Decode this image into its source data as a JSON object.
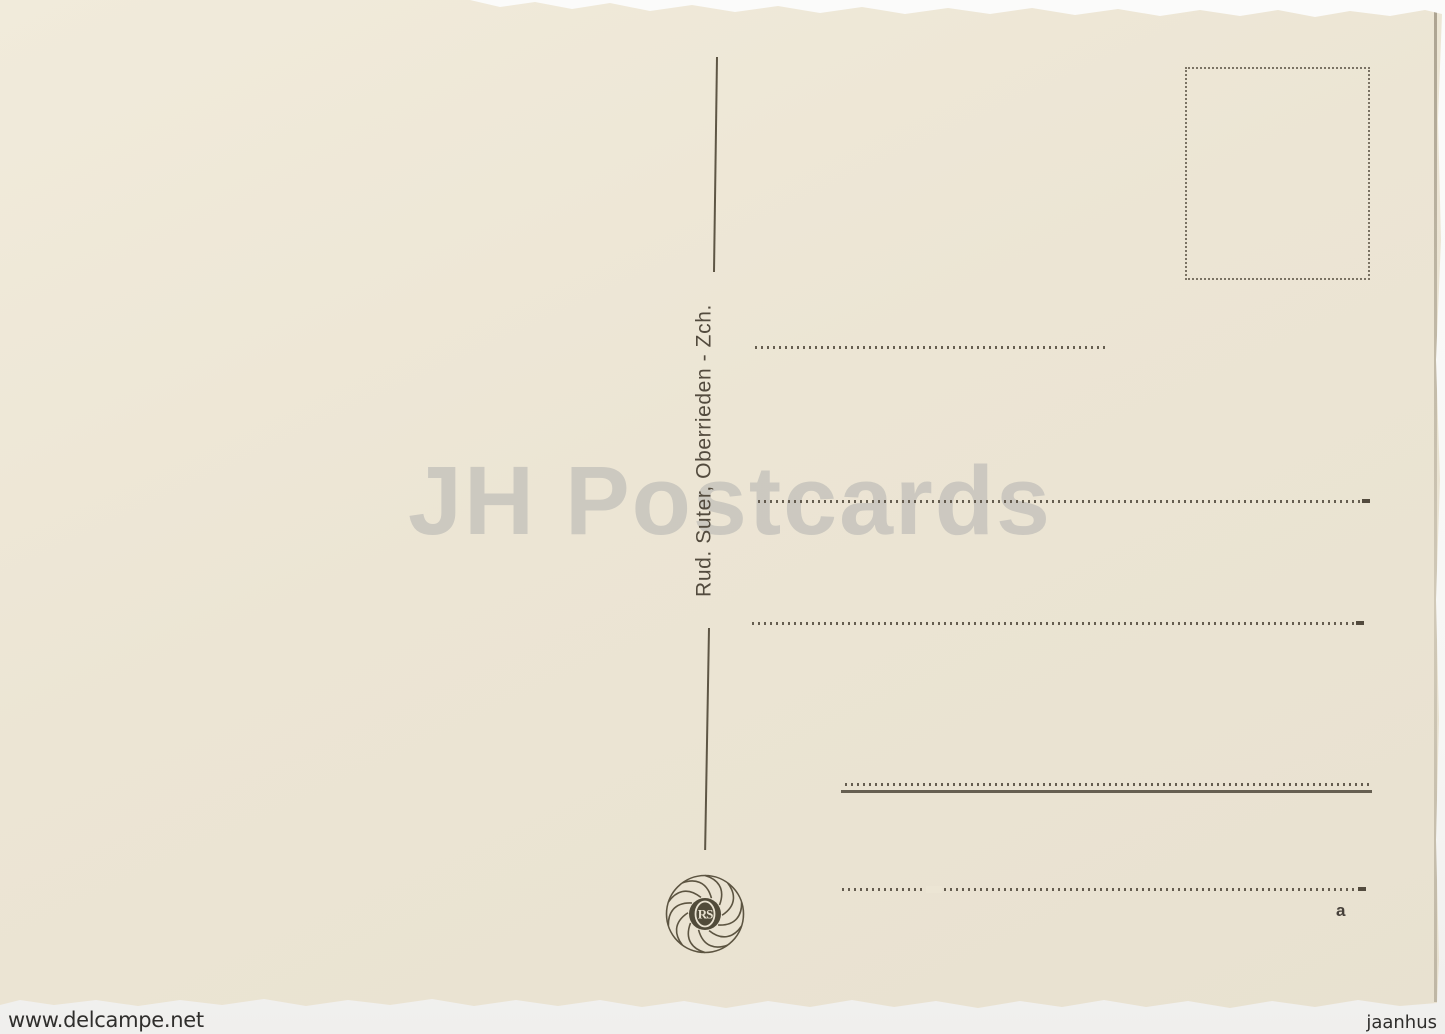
{
  "colors": {
    "page": "#f6f6f4",
    "card": "#ece5d4",
    "ink": "#534b3e",
    "watermark": "#c9c6be",
    "footer-ink": "#2f2e2c"
  },
  "postcard": {
    "publisher_imprint": "Rud. Suter, Oberrieden - Zch.",
    "logo_monogram": "RS",
    "corner_mark": "a"
  },
  "watermark": {
    "text": "JH Postcards"
  },
  "scan_footer": {
    "left": "www.delcampe.net",
    "right": "jaanhus"
  }
}
